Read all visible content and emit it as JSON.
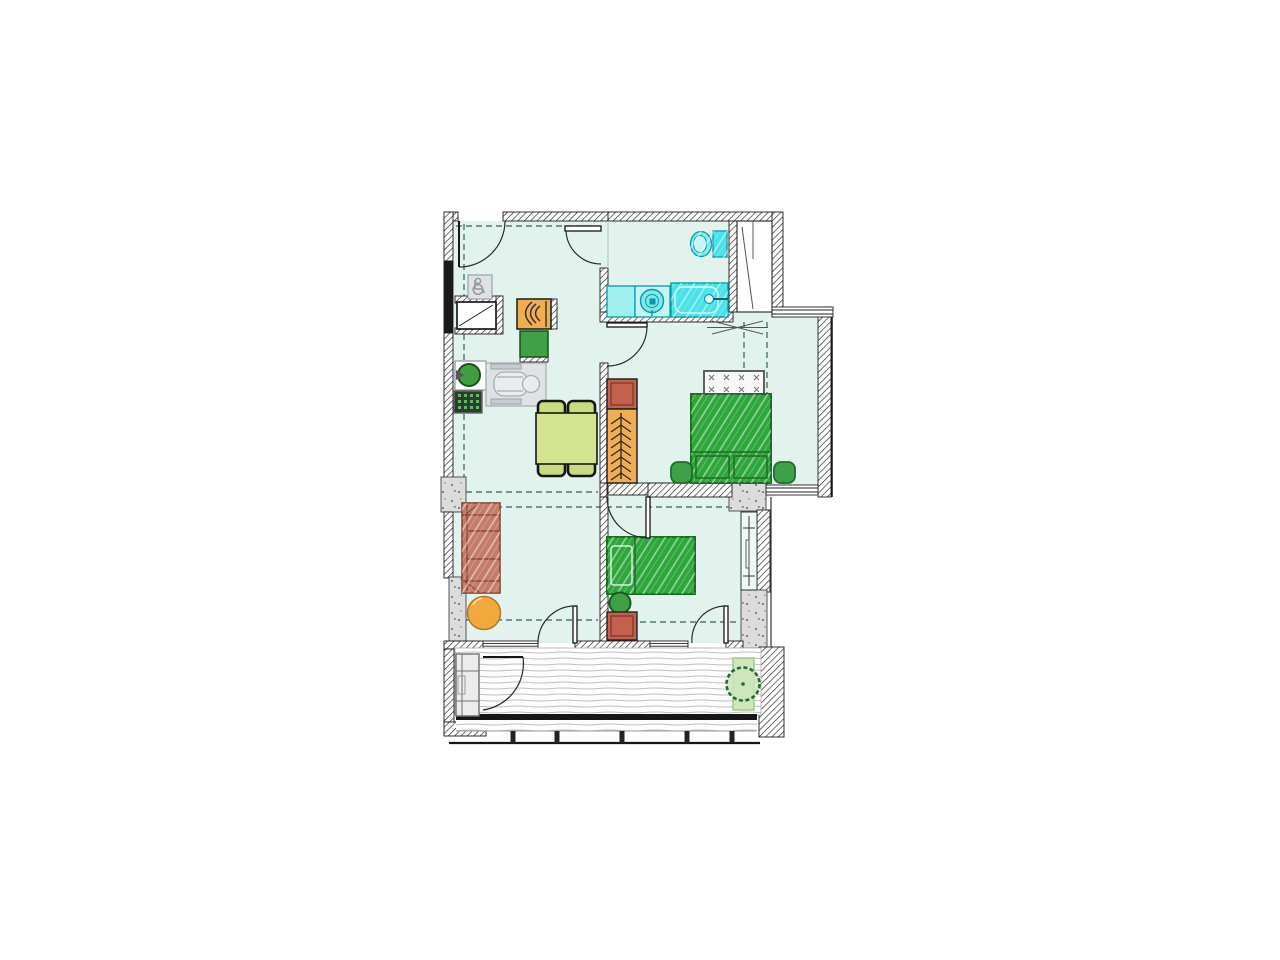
{
  "drawing": {
    "type": "apartment-floor-plan",
    "visible_text": "",
    "rooms_count": 6
  },
  "colors": {
    "floor": "#e2f3ee",
    "wall_black": "#1a1a1a",
    "concrete": "#dcdcdc",
    "bed": "#2fa63c",
    "bed_stroke": "#1b6e24",
    "plant": "#3fa047",
    "pot": "#cfe8b9",
    "bush_fill": "#cfe4bb",
    "bush_stroke": "#1e6b33",
    "table": "#d3e390",
    "chair": "#c8db7f",
    "wardrobe": "#f0ad52",
    "cabinet_red": "#c2614e",
    "sofa": "#c47c6a",
    "pouf": "#f2a93c",
    "tub": "#49e2e8",
    "fixture_light": "#9fefef",
    "fixture_mid": "#7deaea",
    "fixture_pale": "#c5f4f4",
    "fixture_stroke": "#0899a6",
    "sink_green": "#3f9e3f",
    "stove": "#2f3b2f",
    "stove_dot": "#5dbb63",
    "symbol_gray": "#dfe2e4",
    "symbol_stroke": "#a7adb2",
    "dash": "#335f5f",
    "deck_stripe": "#c0c0c0"
  }
}
